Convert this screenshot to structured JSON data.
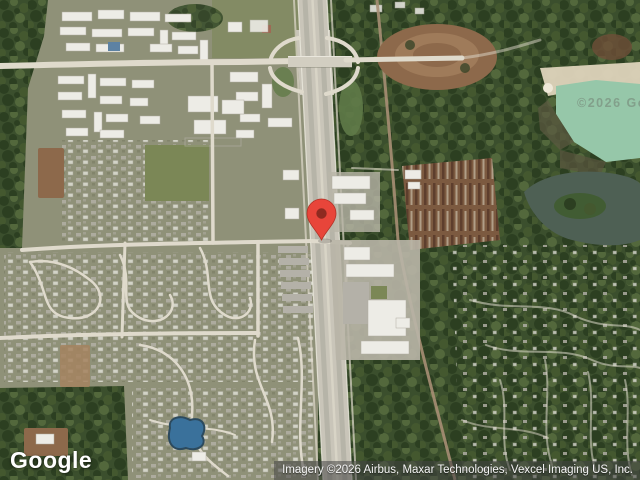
{
  "branding": {
    "logo_text": "Google"
  },
  "attribution": {
    "text": "Imagery ©2026 Airbus, Maxar Technologies, Vexcel Imaging US, Inc."
  },
  "watermark": {
    "text": "©2026 Go"
  },
  "marker": {
    "kind": "red-location-pin"
  },
  "palette": {
    "pin": "#E8453A",
    "pinDark": "#8E2A20",
    "forest": "#3B4F2D",
    "forestDark": "#2C3F21",
    "forestLight": "#53683C",
    "suburb": "#8F9178",
    "street": "#DFDACC",
    "highway": "#C9C5B9",
    "highwayLane": "#B3B0A5",
    "roofWhite": "#EDECE6",
    "roofGray": "#B4B1A8",
    "roofBlue": "#5D82A3",
    "dirt": "#8D694B",
    "dirtLight": "#A5825F",
    "lumber": "#7C5A40",
    "lumberDark": "#57392A",
    "lumberLight": "#B9AA93",
    "lakeGreen": "#96C7A9",
    "pondDark": "#4E6054",
    "pondBlue": "#3A719B",
    "sand": "#DED4BC",
    "grass": "#7B8756"
  }
}
